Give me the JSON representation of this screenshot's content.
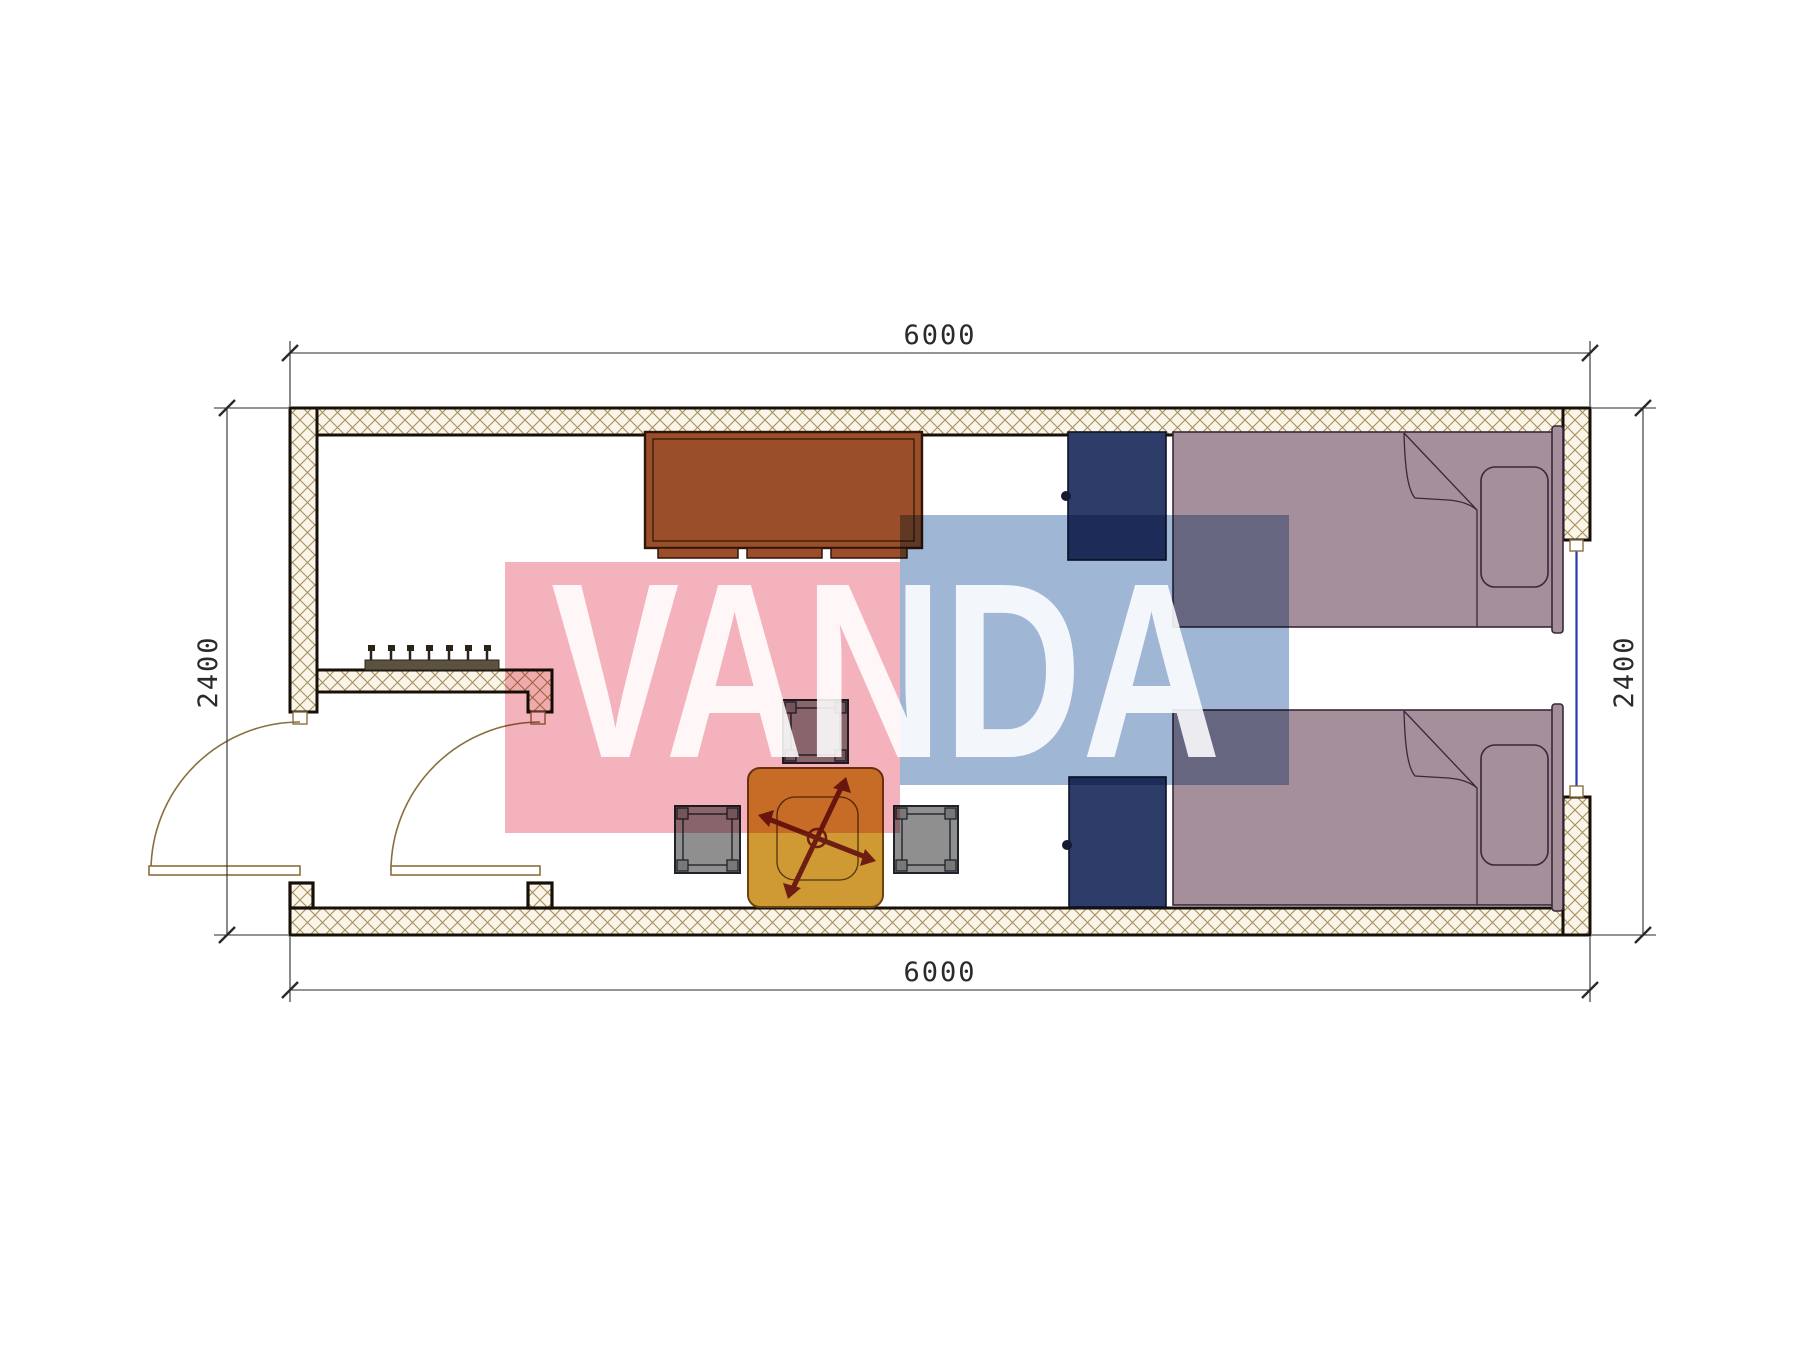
{
  "drawing": {
    "type": "floor-plan",
    "dimensions": {
      "top": "6000",
      "bottom": "6000",
      "left": "2400",
      "right": "2400"
    },
    "watermark": {
      "text": "VANDA"
    },
    "furniture": {
      "desk": "desk",
      "wardrobe_top": "wardrobe",
      "wardrobe_bottom": "wardrobe",
      "bed_top": "single bed",
      "bed_bottom": "single bed",
      "tea_table": "tea table",
      "stools": "3 stools",
      "coat_rack": "coat rack with 7 hooks",
      "doors": "2 swing doors",
      "window": "window in right wall"
    },
    "colors": {
      "hatch-bg": "#faf5e8",
      "hatch-line": "#a4905a",
      "wall-outline": "#171008",
      "desk": "#9a4e29",
      "wardrobe": "#2e3c6a",
      "bed": "#a58f9b",
      "table": "#cf9a33",
      "stool": "#8f8f8f",
      "rack": "#5c5240",
      "door": "#8a6f3c",
      "window": "#2a3ab0",
      "dim": "#2a2a2a",
      "wm-pink": "#f2a4b2",
      "wm-blue": "#8ea9ce"
    }
  }
}
